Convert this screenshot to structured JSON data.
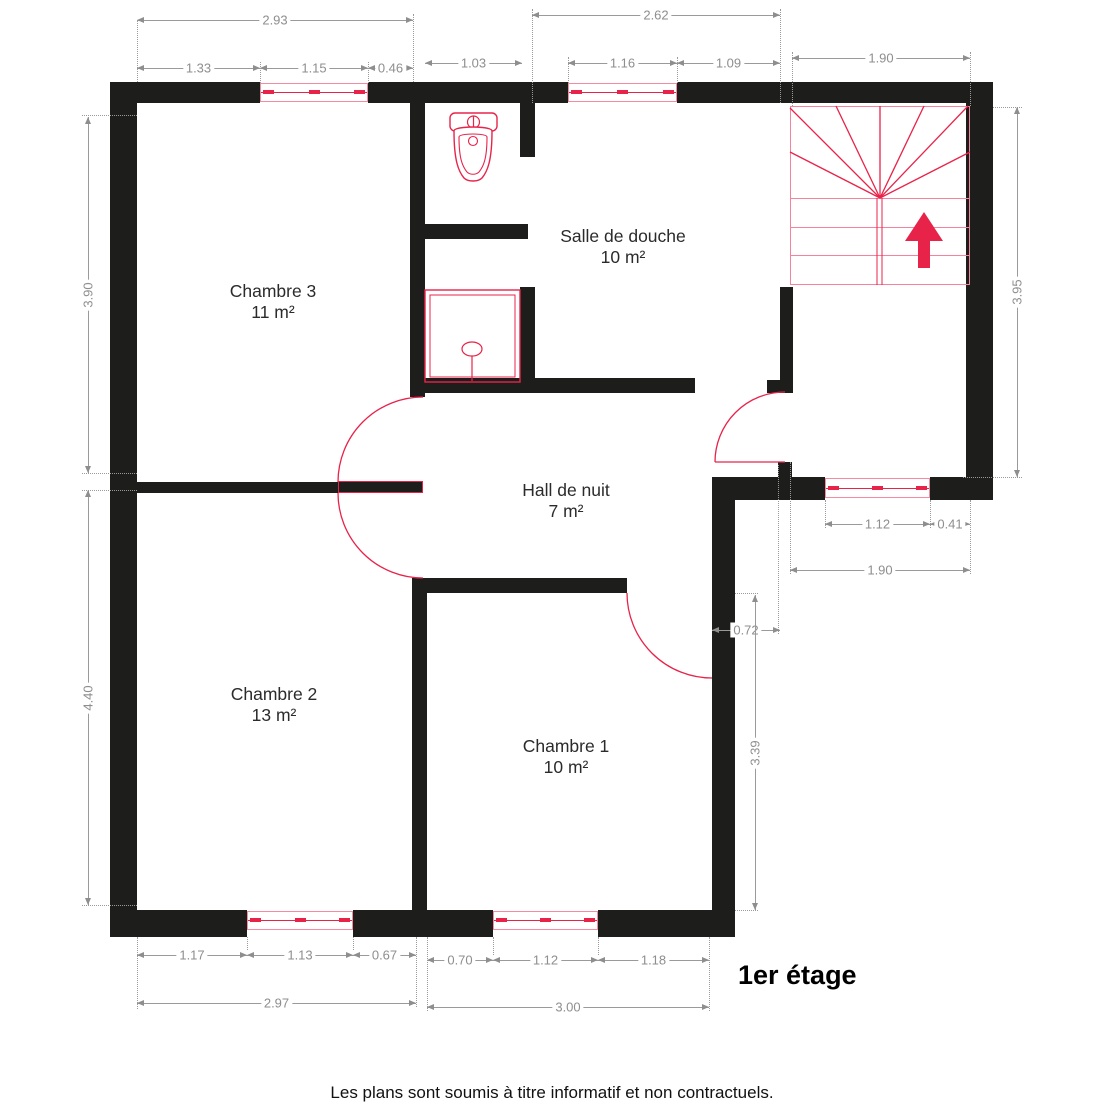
{
  "meta": {
    "floor_label": "1er étage",
    "disclaimer": "Les plans sont soumis à titre informatif et non contractuels."
  },
  "colors": {
    "wall": "#1d1d1b",
    "red": "#e8234a",
    "pink": "#f4849b",
    "dim_gray": "#9a9a9a"
  },
  "rooms": [
    {
      "name": "Chambre 3",
      "area": "11 m²",
      "cx": 273,
      "cy": 281
    },
    {
      "name": "Salle de douche",
      "area": "10 m²",
      "cx": 623,
      "cy": 226
    },
    {
      "name": "Hall de nuit",
      "area": "7 m²",
      "cx": 566,
      "cy": 480
    },
    {
      "name": "Chambre 2",
      "area": "13 m²",
      "cx": 274,
      "cy": 684
    },
    {
      "name": "Chambre 1",
      "area": "10 m²",
      "cx": 566,
      "cy": 736
    }
  ],
  "walls": [
    [
      110,
      82,
      150,
      21
    ],
    [
      368,
      82,
      200,
      21
    ],
    [
      677,
      82,
      316,
      21
    ],
    [
      110,
      82,
      27,
      855
    ],
    [
      966,
      82,
      27,
      418
    ],
    [
      712,
      477,
      113,
      23
    ],
    [
      930,
      477,
      63,
      23
    ],
    [
      712,
      477,
      23,
      460
    ],
    [
      110,
      910,
      137,
      27
    ],
    [
      353,
      910,
      74,
      27
    ],
    [
      427,
      910,
      66,
      27
    ],
    [
      598,
      910,
      114,
      27
    ],
    [
      410,
      103,
      15,
      294
    ],
    [
      520,
      103,
      15,
      54
    ],
    [
      410,
      224,
      118,
      15
    ],
    [
      520,
      287,
      15,
      106
    ],
    [
      410,
      378,
      285,
      15
    ],
    [
      767,
      380,
      23,
      13
    ],
    [
      780,
      287,
      13,
      106
    ],
    [
      137,
      482,
      201,
      11
    ],
    [
      412,
      578,
      15,
      332
    ],
    [
      427,
      578,
      200,
      15
    ],
    [
      778,
      462,
      14,
      15
    ]
  ],
  "door_leaf": [
    338,
    481,
    85,
    12
  ],
  "windows": [
    [
      260,
      83,
      108,
      19
    ],
    [
      568,
      83,
      109,
      19
    ],
    [
      825,
      478,
      105,
      20
    ],
    [
      247,
      911,
      106,
      19
    ],
    [
      493,
      911,
      105,
      19
    ]
  ],
  "door_arcs": [
    {
      "name": "door-chambre3",
      "d": "M 338 482 A 85 85 0 0 1 423 397"
    },
    {
      "name": "door-chambre2",
      "d": "M 338 493 A 85 85 0 0 0 423 578"
    },
    {
      "name": "door-chambre1",
      "d": "M 627 593 A 85 85 0 0 0 712 678"
    },
    {
      "name": "door-stairs",
      "d": "M 715 462 L 785 462 M 715 462 A 70 70 0 0 1 785 392"
    }
  ],
  "stairs": {
    "box": [
      790,
      106,
      180,
      179
    ],
    "treads_y": [
      198,
      227,
      255
    ],
    "tread_x": [
      790,
      970
    ],
    "divider_x": [
      877,
      882
    ],
    "divider_y": [
      198,
      285
    ],
    "fan_center": [
      880,
      198
    ],
    "fan_tips": [
      [
        790,
        108
      ],
      [
        790,
        152
      ],
      [
        836,
        106
      ],
      [
        880,
        106
      ],
      [
        924,
        106
      ],
      [
        968,
        106
      ],
      [
        970,
        152
      ]
    ],
    "arrow_polygon": "924,212 905,241 918,241 918,268 930,268 930,241 943,241"
  },
  "fixtures": {
    "toilet": {
      "tank": [
        450,
        113,
        47,
        18
      ],
      "flush_circle": [
        473.5,
        122,
        6
      ],
      "bowl_outer": "M 454 131 C 454 162 459 172 464 178 C 468 182 478 182 482 178 C 487 172 492 162 492 131 C 492 127 473 127 473 127 C 473 127 454 127 454 131 Z",
      "bowl_inner": "M 459 137 C 459 160 463 167 467 172 C 470 175 476 175 479 172 C 483 167 487 160 487 137 C 487 134 473 134 473 134 C 473 134 459 134 459 137 Z",
      "drain_circle": [
        473,
        141,
        4.5
      ]
    },
    "shower": {
      "outer": [
        425,
        290,
        95,
        92
      ],
      "inner": [
        430,
        295,
        85,
        82
      ],
      "head_ellipse": [
        472,
        349,
        10,
        7
      ],
      "stem": [
        472,
        356,
        472,
        381
      ]
    }
  },
  "dims_h": [
    {
      "label": "2.93",
      "x1": 137,
      "x2": 413,
      "y": 20
    },
    {
      "label": "1.33",
      "x1": 137,
      "x2": 260,
      "y": 68
    },
    {
      "label": "1.15",
      "x1": 260,
      "x2": 368,
      "y": 68
    },
    {
      "label": "0.46",
      "x1": 368,
      "x2": 413,
      "y": 68
    },
    {
      "label": "2.62",
      "x1": 532,
      "x2": 780,
      "y": 15
    },
    {
      "label": "1.03",
      "x1": 425,
      "x2": 522,
      "y": 63
    },
    {
      "label": "1.16",
      "x1": 568,
      "x2": 677,
      "y": 63
    },
    {
      "label": "1.09",
      "x1": 677,
      "x2": 780,
      "y": 63
    },
    {
      "label": "1.90",
      "x1": 792,
      "x2": 970,
      "y": 58
    },
    {
      "label": "1.12",
      "x1": 825,
      "x2": 930,
      "y": 524
    },
    {
      "label": "0.41",
      "x1": 930,
      "x2": 970,
      "y": 524
    },
    {
      "label": "1.90",
      "x1": 790,
      "x2": 970,
      "y": 570
    },
    {
      "label": "0.72",
      "x1": 712,
      "x2": 780,
      "y": 630
    },
    {
      "label": "1.17",
      "x1": 137,
      "x2": 247,
      "y": 955
    },
    {
      "label": "1.13",
      "x1": 247,
      "x2": 353,
      "y": 955
    },
    {
      "label": "0.67",
      "x1": 353,
      "x2": 416,
      "y": 955
    },
    {
      "label": "2.97",
      "x1": 137,
      "x2": 416,
      "y": 1003
    },
    {
      "label": "0.70",
      "x1": 427,
      "x2": 493,
      "y": 960
    },
    {
      "label": "1.12",
      "x1": 493,
      "x2": 598,
      "y": 960
    },
    {
      "label": "1.18",
      "x1": 598,
      "x2": 709,
      "y": 960
    },
    {
      "label": "3.00",
      "x1": 427,
      "x2": 709,
      "y": 1007
    }
  ],
  "dims_v": [
    {
      "label": "3.90",
      "x": 88,
      "y1": 117,
      "y2": 473
    },
    {
      "label": "4.40",
      "x": 88,
      "y1": 490,
      "y2": 905
    },
    {
      "label": "3.95",
      "x": 1017,
      "y1": 107,
      "y2": 477
    },
    {
      "label": "3.39",
      "x": 755,
      "y1": 595,
      "y2": 910
    }
  ],
  "ext_v": [
    [
      137,
      20,
      82
    ],
    [
      260,
      62,
      83
    ],
    [
      368,
      62,
      83
    ],
    [
      413,
      14,
      82
    ],
    [
      532,
      9,
      103
    ],
    [
      568,
      57,
      83
    ],
    [
      677,
      57,
      83
    ],
    [
      780,
      9,
      103
    ],
    [
      792,
      52,
      106
    ],
    [
      970,
      52,
      106
    ],
    [
      825,
      500,
      528
    ],
    [
      930,
      500,
      528
    ],
    [
      790,
      462,
      574
    ],
    [
      970,
      500,
      574
    ],
    [
      778,
      465,
      634
    ],
    [
      137,
      937,
      1009
    ],
    [
      247,
      937,
      950
    ],
    [
      353,
      937,
      950
    ],
    [
      416,
      937,
      1007
    ],
    [
      427,
      937,
      1011
    ],
    [
      493,
      937,
      955
    ],
    [
      598,
      937,
      955
    ],
    [
      709,
      937,
      1011
    ]
  ],
  "ext_h": [
    [
      115,
      82,
      137
    ],
    [
      473,
      82,
      137
    ],
    [
      490,
      82,
      137
    ],
    [
      905,
      82,
      137
    ],
    [
      107,
      993,
      1022
    ],
    [
      477,
      963,
      1022
    ],
    [
      593,
      735,
      758
    ],
    [
      910,
      735,
      758
    ]
  ],
  "floor_label_pos": [
    738,
    960
  ],
  "footer_y": 1083
}
